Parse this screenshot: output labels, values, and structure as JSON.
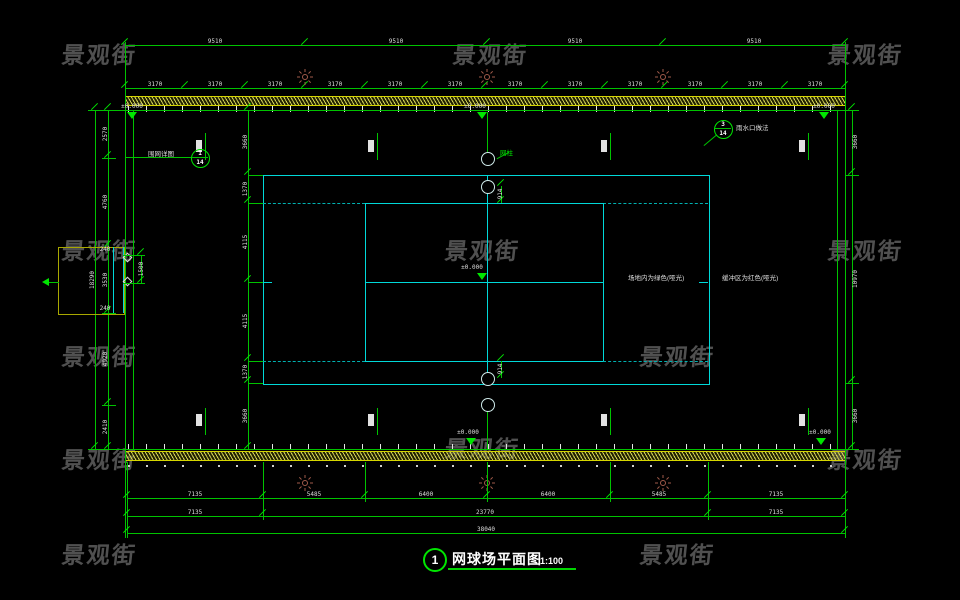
{
  "watermark": {
    "text": "景观街"
  },
  "title_block": {
    "number": "1",
    "title": "网球场平面图",
    "scale": "1:100"
  },
  "annotations": {
    "level_text": "±0.000",
    "net_post": "网柱",
    "callout_fence": {
      "num": "1",
      "sheet": "14",
      "label": "围网详图"
    },
    "callout_drain": {
      "num": "3",
      "sheet": "14",
      "label": "雨水口做法"
    },
    "surface_inner": "场地内为绿色(哑光)",
    "surface_buffer": "缓冲区为红色(哑光)",
    "gate_width": "1500",
    "gate_wall_top": "240",
    "gate_wall_bottom": "240",
    "net_offset_top": "914",
    "net_offset_bottom": "914"
  },
  "dimensions": {
    "top_outer": [
      "9510",
      "9510",
      "9510",
      "9510"
    ],
    "top_inner": [
      "3170",
      "3170",
      "3170",
      "3170",
      "3170",
      "3170",
      "3170",
      "3170",
      "3170",
      "3170",
      "3170",
      "3170"
    ],
    "left_total": "18290",
    "left_chain": [
      "2570",
      "4760",
      "3530",
      "4920",
      "2410"
    ],
    "court_chain": [
      "3660",
      "1370",
      "4115",
      "4115",
      "1370",
      "3660"
    ],
    "right_chain": [
      "3660",
      "10970",
      "3660"
    ],
    "bottom_detail": [
      "7135",
      "5485",
      "6400",
      "6400",
      "5485",
      "7135"
    ],
    "bottom_mid": [
      "7135",
      "23770",
      "7135"
    ],
    "bottom_total": "38040"
  }
}
